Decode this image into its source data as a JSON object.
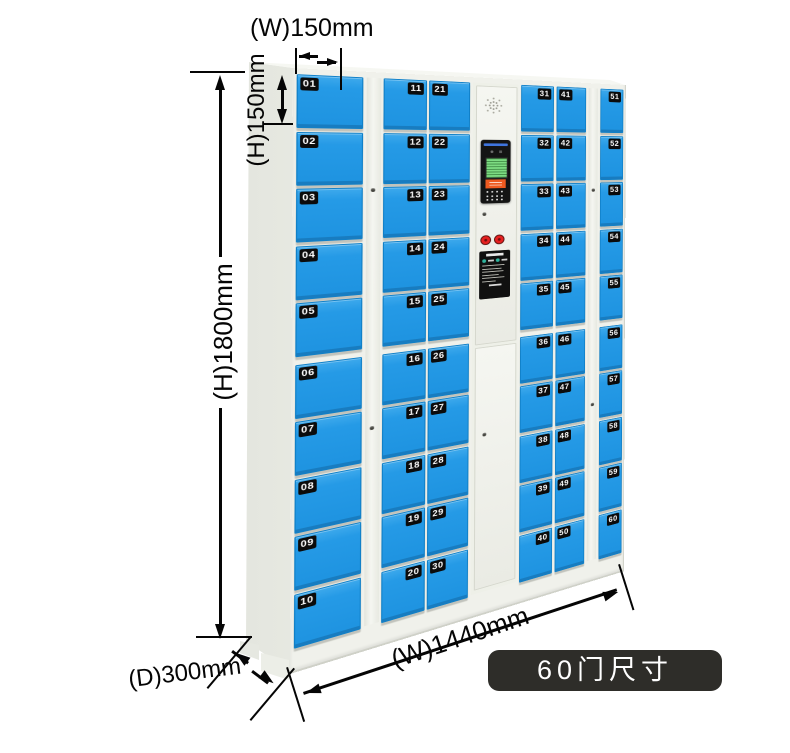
{
  "caption": {
    "text": "60门尺寸"
  },
  "dimensions": {
    "door_width": {
      "label": "(W)150mm"
    },
    "door_height": {
      "label": "(H)150mm"
    },
    "cabinet_height": {
      "label": "(H)1800mm"
    },
    "cabinet_depth": {
      "label": "(D)300mm"
    },
    "cabinet_width": {
      "label": "(W)1440mm"
    }
  },
  "locker": {
    "total_doors": 60,
    "columns": [
      {
        "name": "column-01-10",
        "badge_side": "left",
        "doors": [
          "01",
          "02",
          "03",
          "04",
          "05",
          "06",
          "07",
          "08",
          "09",
          "10"
        ]
      },
      {
        "name": "column-11-20",
        "badge_side": "right",
        "doors": [
          "11",
          "12",
          "13",
          "14",
          "15",
          "16",
          "17",
          "18",
          "19",
          "20"
        ]
      },
      {
        "name": "column-21-30",
        "badge_side": "left",
        "doors": [
          "21",
          "22",
          "23",
          "24",
          "25",
          "26",
          "27",
          "28",
          "29",
          "30"
        ]
      },
      {
        "name": "column-31-40",
        "badge_side": "right",
        "doors": [
          "31",
          "32",
          "33",
          "34",
          "35",
          "36",
          "37",
          "38",
          "39",
          "40"
        ]
      },
      {
        "name": "column-41-50",
        "badge_side": "left",
        "doors": [
          "41",
          "42",
          "43",
          "44",
          "45",
          "46",
          "47",
          "48",
          "49",
          "50"
        ]
      },
      {
        "name": "column-51-60",
        "badge_side": "right",
        "doors": [
          "51",
          "52",
          "53",
          "54",
          "55",
          "56",
          "57",
          "58",
          "59",
          "60"
        ]
      }
    ],
    "control_unit": {
      "icons": [
        "speaker-grille-icon",
        "camera-icon",
        "lcd-screen",
        "orange-scanner",
        "keypad-dots-icon",
        "keyhole-icon",
        "red-button-left",
        "red-button-right",
        "instruction-label"
      ]
    }
  },
  "colors": {
    "door_blue": "#259ae6",
    "badge_bg": "#0b0b0b",
    "caption_bg": "#2e2d29",
    "dimension_lines": "#050505",
    "cabinet_frame": "#f0f1eb",
    "cabinet_side": "#e7e9e2"
  }
}
